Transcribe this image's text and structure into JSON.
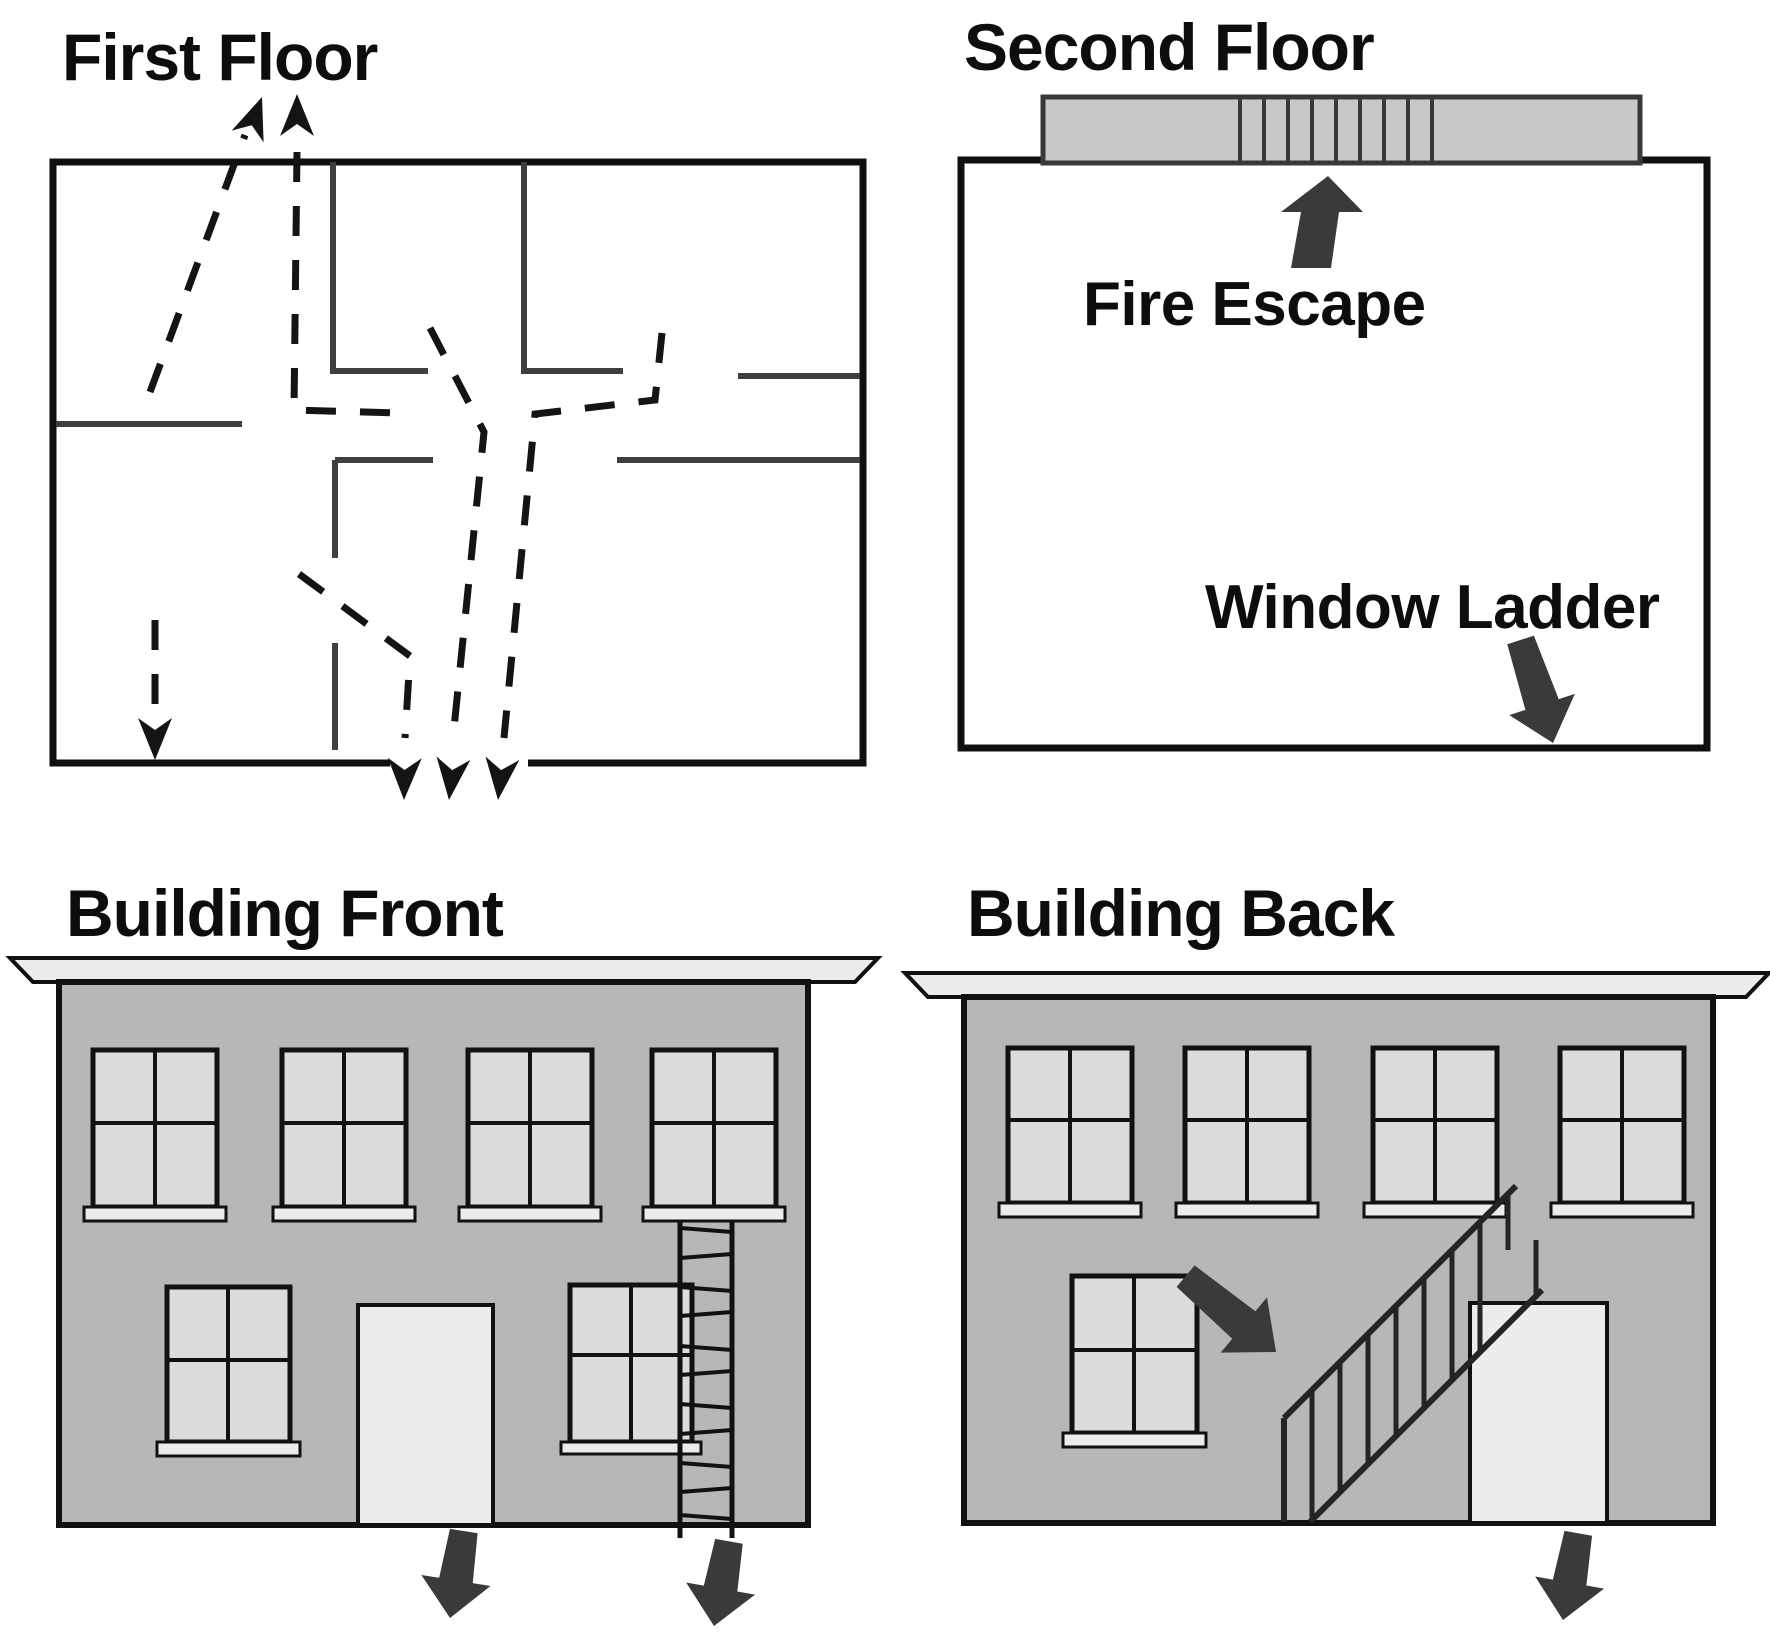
{
  "diagram": {
    "type": "fire-escape-plan",
    "colors": {
      "background": "#ffffff",
      "wall_line": "#3f3f3f",
      "route_dash": "#141414",
      "facade_gray": "#b7b7b7",
      "pane_gray": "#dcdcdc",
      "light_gray": "#ececec",
      "platform_gray": "#c9c9c9",
      "arrow_dark": "#3a3a3a"
    }
  },
  "panels": {
    "first_floor": {
      "title": "First Floor"
    },
    "second_floor": {
      "title": "Second Floor",
      "fire_escape_label": "Fire Escape",
      "window_ladder_label": "Window Ladder"
    },
    "building_front": {
      "title": "Building Front"
    },
    "building_back": {
      "title": "Building Back"
    }
  }
}
